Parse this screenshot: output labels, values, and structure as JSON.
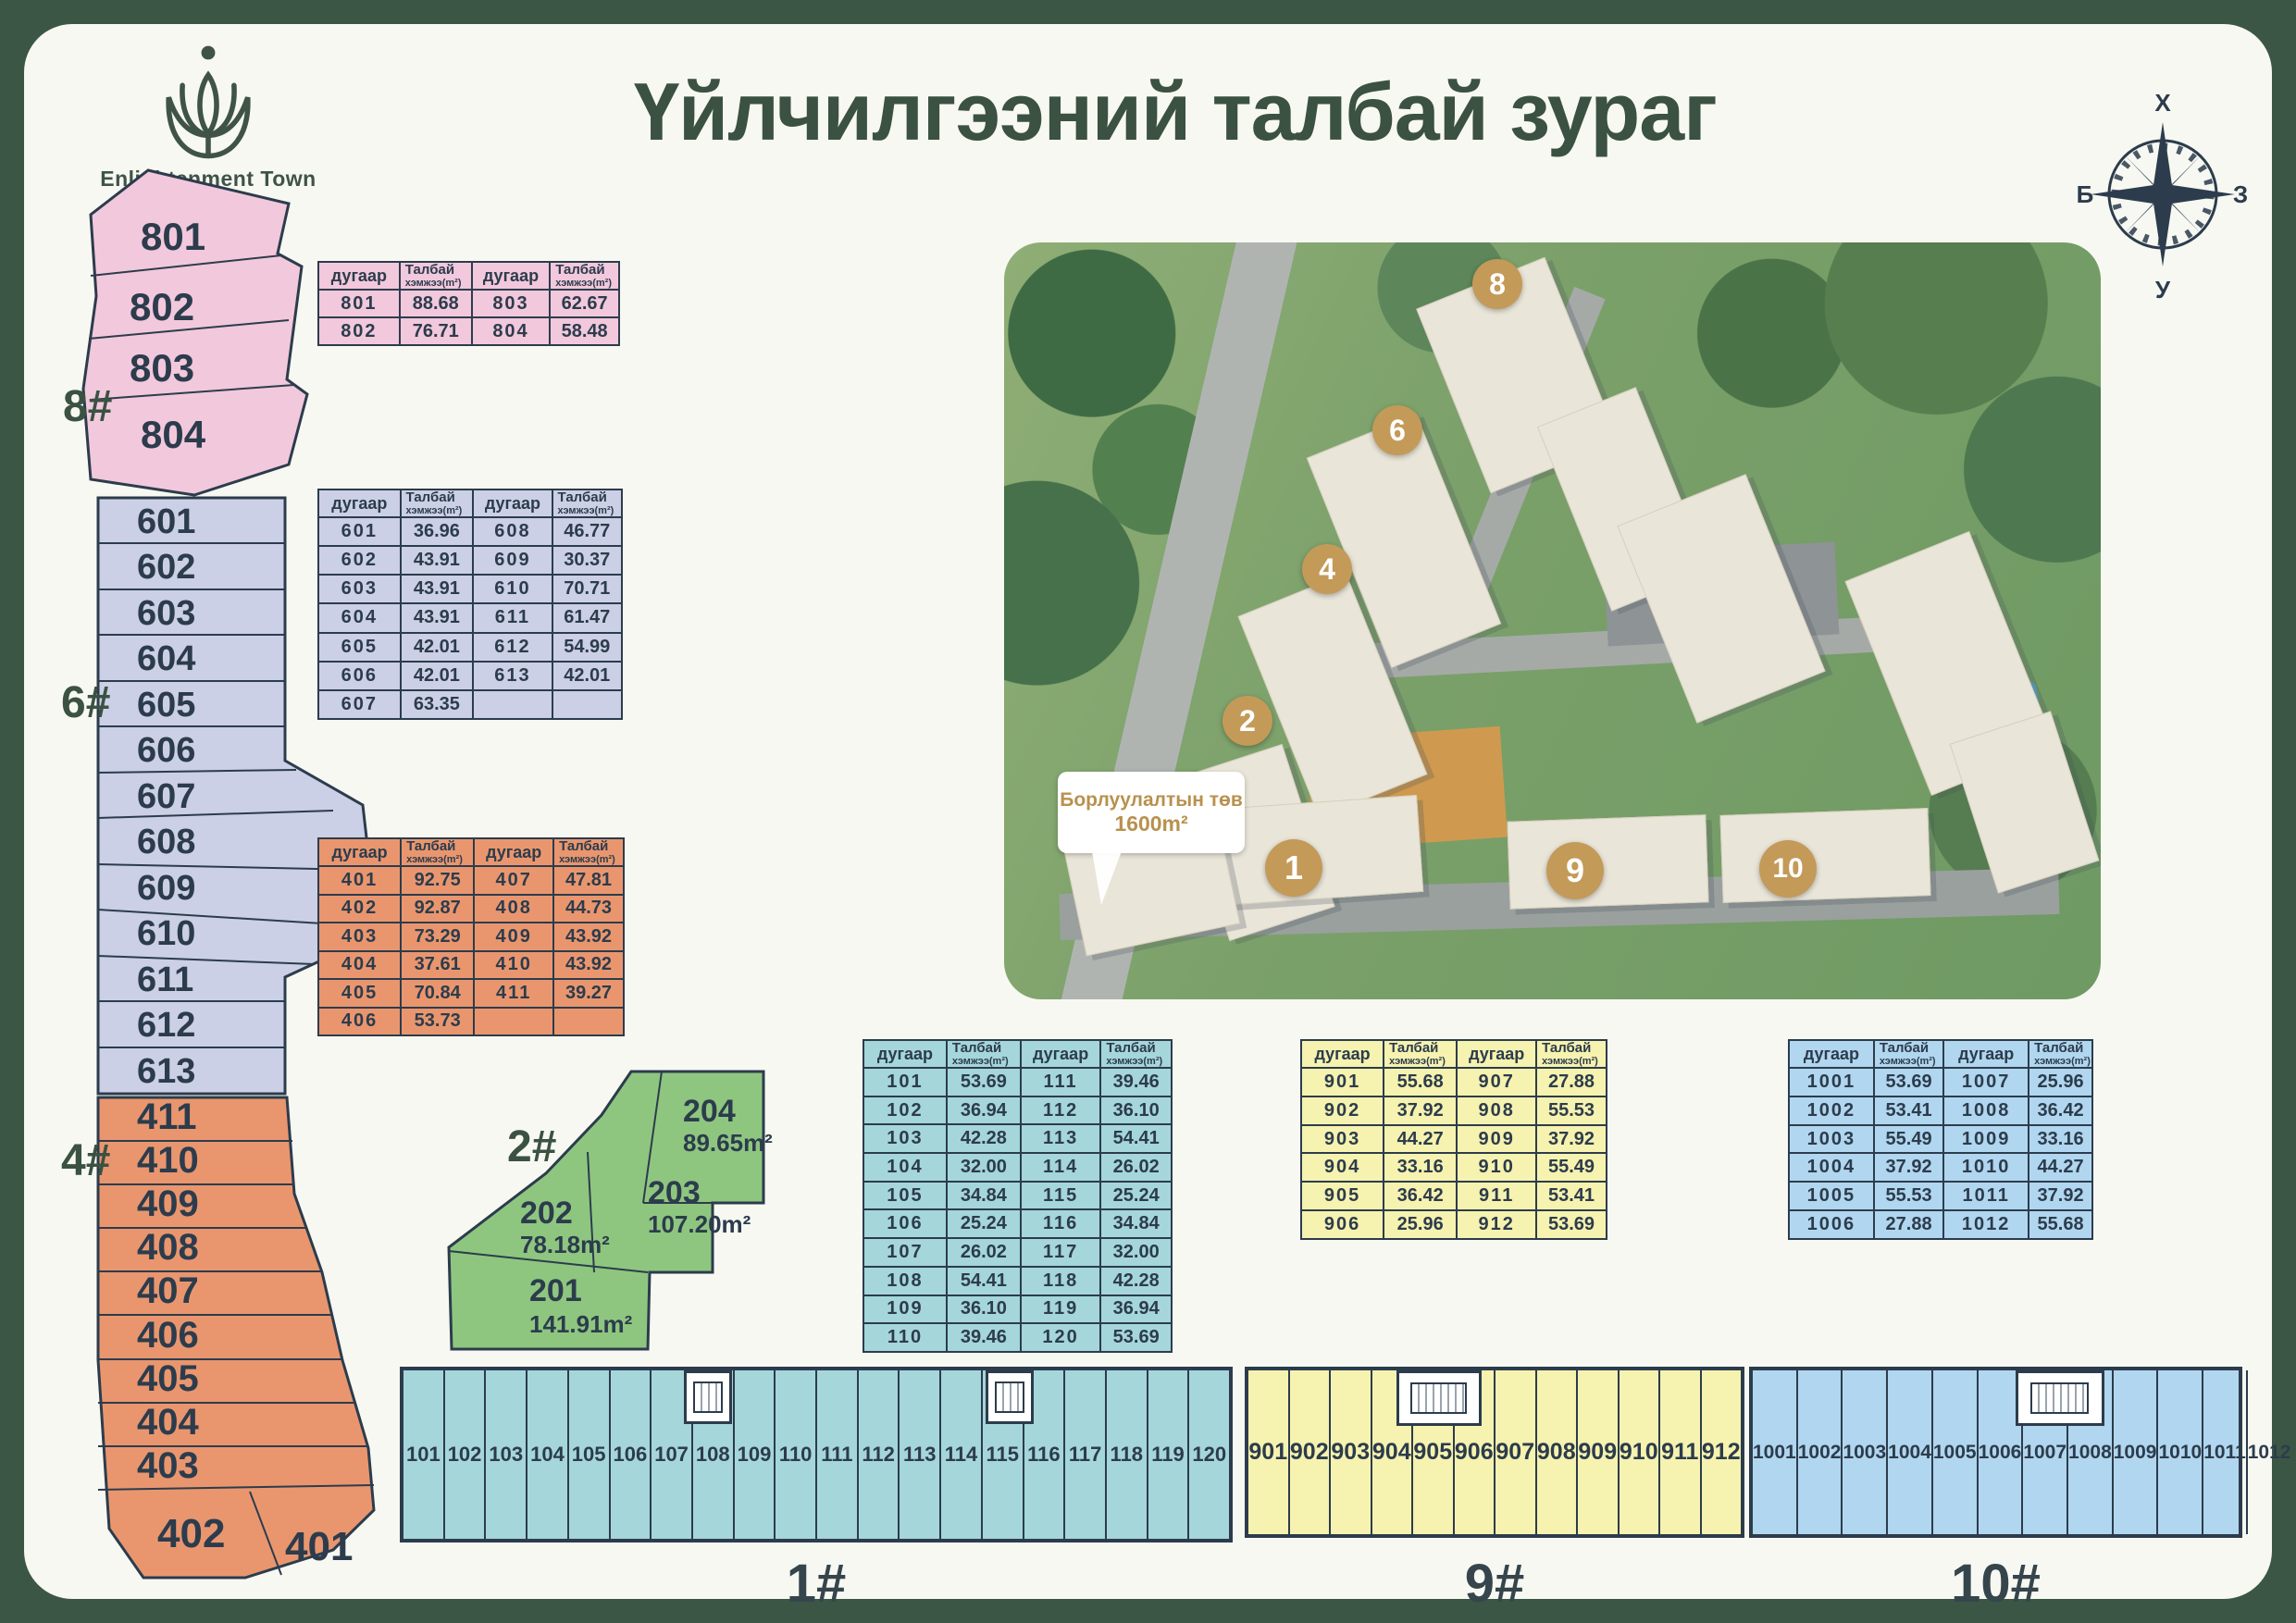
{
  "page": {
    "title": "Үйлчилгээний талбай зураг"
  },
  "logo": {
    "name": "Enlightenment Town"
  },
  "compass": {
    "north": "Х",
    "east": "З",
    "south": "У",
    "west": "Б"
  },
  "colors": {
    "frame_green": "#3c5646",
    "title_green": "#3b5142",
    "plan_ink": "#2c3c4c",
    "pink": "#f2c8dc",
    "lavender": "#cbd0e6",
    "orange": "#e9966f",
    "green": "#8ec680",
    "cyan": "#a5d6da",
    "yellow": "#f6f2af",
    "blue": "#b1d6ef",
    "badge_gold": "#c49a58",
    "sales_gold": "#b8914e"
  },
  "header_labels": {
    "num": "дугаар",
    "area_line1": "Талбай",
    "area_line2": "хэмжээ(m²)"
  },
  "tables": {
    "t8": {
      "rows": [
        [
          "801",
          "88.68",
          "803",
          "62.67"
        ],
        [
          "802",
          "76.71",
          "804",
          "58.48"
        ]
      ]
    },
    "t6": {
      "rows": [
        [
          "601",
          "36.96",
          "608",
          "46.77"
        ],
        [
          "602",
          "43.91",
          "609",
          "30.37"
        ],
        [
          "603",
          "43.91",
          "610",
          "70.71"
        ],
        [
          "604",
          "43.91",
          "611",
          "61.47"
        ],
        [
          "605",
          "42.01",
          "612",
          "54.99"
        ],
        [
          "606",
          "42.01",
          "613",
          "42.01"
        ],
        [
          "607",
          "63.35",
          "",
          ""
        ]
      ]
    },
    "t4": {
      "rows": [
        [
          "401",
          "92.75",
          "407",
          "47.81"
        ],
        [
          "402",
          "92.87",
          "408",
          "44.73"
        ],
        [
          "403",
          "73.29",
          "409",
          "43.92"
        ],
        [
          "404",
          "37.61",
          "410",
          "43.92"
        ],
        [
          "405",
          "70.84",
          "411",
          "39.27"
        ],
        [
          "406",
          "53.73",
          "",
          ""
        ]
      ]
    },
    "t1": {
      "rows": [
        [
          "101",
          "53.69",
          "111",
          "39.46"
        ],
        [
          "102",
          "36.94",
          "112",
          "36.10"
        ],
        [
          "103",
          "42.28",
          "113",
          "54.41"
        ],
        [
          "104",
          "32.00",
          "114",
          "26.02"
        ],
        [
          "105",
          "34.84",
          "115",
          "25.24"
        ],
        [
          "106",
          "25.24",
          "116",
          "34.84"
        ],
        [
          "107",
          "26.02",
          "117",
          "32.00"
        ],
        [
          "108",
          "54.41",
          "118",
          "42.28"
        ],
        [
          "109",
          "36.10",
          "119",
          "36.94"
        ],
        [
          "110",
          "39.46",
          "120",
          "53.69"
        ]
      ]
    },
    "t9": {
      "rows": [
        [
          "901",
          "55.68",
          "907",
          "27.88"
        ],
        [
          "902",
          "37.92",
          "908",
          "55.53"
        ],
        [
          "903",
          "44.27",
          "909",
          "37.92"
        ],
        [
          "904",
          "33.16",
          "910",
          "55.49"
        ],
        [
          "905",
          "36.42",
          "911",
          "53.41"
        ],
        [
          "906",
          "25.96",
          "912",
          "53.69"
        ]
      ]
    },
    "t10": {
      "rows": [
        [
          "1001",
          "53.69",
          "1007",
          "25.96"
        ],
        [
          "1002",
          "53.41",
          "1008",
          "36.42"
        ],
        [
          "1003",
          "55.49",
          "1009",
          "33.16"
        ],
        [
          "1004",
          "37.92",
          "1010",
          "44.27"
        ],
        [
          "1005",
          "55.53",
          "1011",
          "37.92"
        ],
        [
          "1006",
          "27.88",
          "1012",
          "55.68"
        ]
      ]
    }
  },
  "plans": {
    "b8": {
      "label": "8#",
      "units": [
        "801",
        "802",
        "803",
        "804"
      ]
    },
    "b6": {
      "label": "6#",
      "units": [
        "601",
        "602",
        "603",
        "604",
        "605",
        "606",
        "607",
        "608",
        "609",
        "610",
        "611",
        "612",
        "613"
      ]
    },
    "b4": {
      "label": "4#",
      "units": [
        "411",
        "410",
        "409",
        "408",
        "407",
        "406",
        "405",
        "404",
        "403",
        "402",
        "401"
      ]
    },
    "b2": {
      "label": "2#",
      "units": [
        {
          "id": "204",
          "area": "89.65m²"
        },
        {
          "id": "203",
          "area": "107.20m²"
        },
        {
          "id": "202",
          "area": "78.18m²"
        },
        {
          "id": "201",
          "area": "141.91m²"
        }
      ]
    },
    "s1": {
      "label": "1#",
      "units": [
        "101",
        "102",
        "103",
        "104",
        "105",
        "106",
        "107",
        "108",
        "109",
        "110",
        "111",
        "112",
        "113",
        "114",
        "115",
        "116",
        "117",
        "118",
        "119",
        "120"
      ]
    },
    "s9": {
      "label": "9#",
      "units": [
        "901",
        "902",
        "903",
        "904",
        "905",
        "906",
        "907",
        "908",
        "909",
        "910",
        "911",
        "912"
      ]
    },
    "s10": {
      "label": "10#",
      "units": [
        "1001",
        "1002",
        "1003",
        "1004",
        "1005",
        "1006",
        "1007",
        "1008",
        "1009",
        "1010",
        "1011",
        "1012"
      ]
    }
  },
  "aerial": {
    "badges": [
      "8",
      "6",
      "4",
      "2",
      "1",
      "9",
      "10"
    ],
    "sales_center": {
      "line1": "Борлуулалтын төв",
      "line2": "1600m²"
    }
  }
}
